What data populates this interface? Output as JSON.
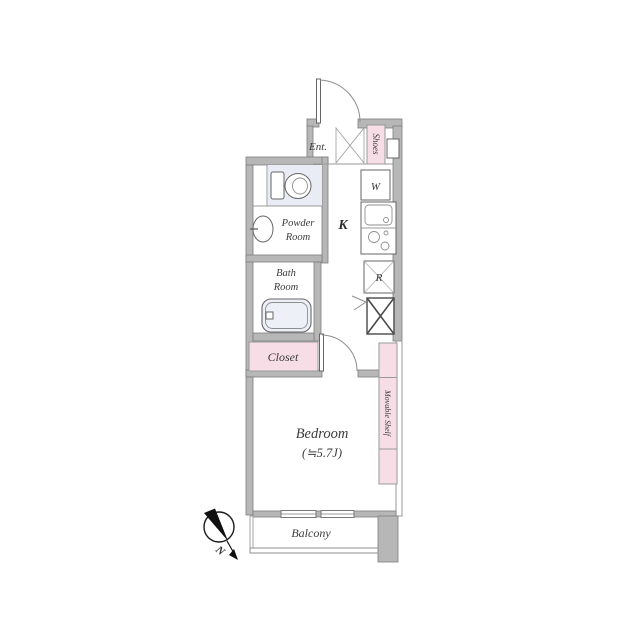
{
  "plan_title": "1K apartment floor plan",
  "colors": {
    "background": "#ffffff",
    "wall_gray": "#b7b7b7",
    "wall_edge": "#7d7d7d",
    "accent_pink": "#f7dde6",
    "fixture_blue": "#edf0f7",
    "toilet_floor": "#e9ecf4",
    "line_gray": "#8f8f8f",
    "ink": "#1a1a1a"
  },
  "rooms": {
    "entrance": {
      "label": "Ent."
    },
    "shoes": {
      "label": "Shoes"
    },
    "kitchen": {
      "label": "K"
    },
    "washer": {
      "label": "W"
    },
    "fridge": {
      "label": "R"
    },
    "powder_room": {
      "line1": "Powder",
      "line2": "Room"
    },
    "bath_room": {
      "line1": "Bath",
      "line2": "Room"
    },
    "closet": {
      "label": "Closet"
    },
    "bedroom": {
      "label": "Bedroom",
      "size": "(≒5.7J)"
    },
    "shelf": {
      "label": "Movable Shelf"
    },
    "balcony": {
      "label": "Balcony"
    }
  },
  "compass": {
    "label": "N"
  }
}
